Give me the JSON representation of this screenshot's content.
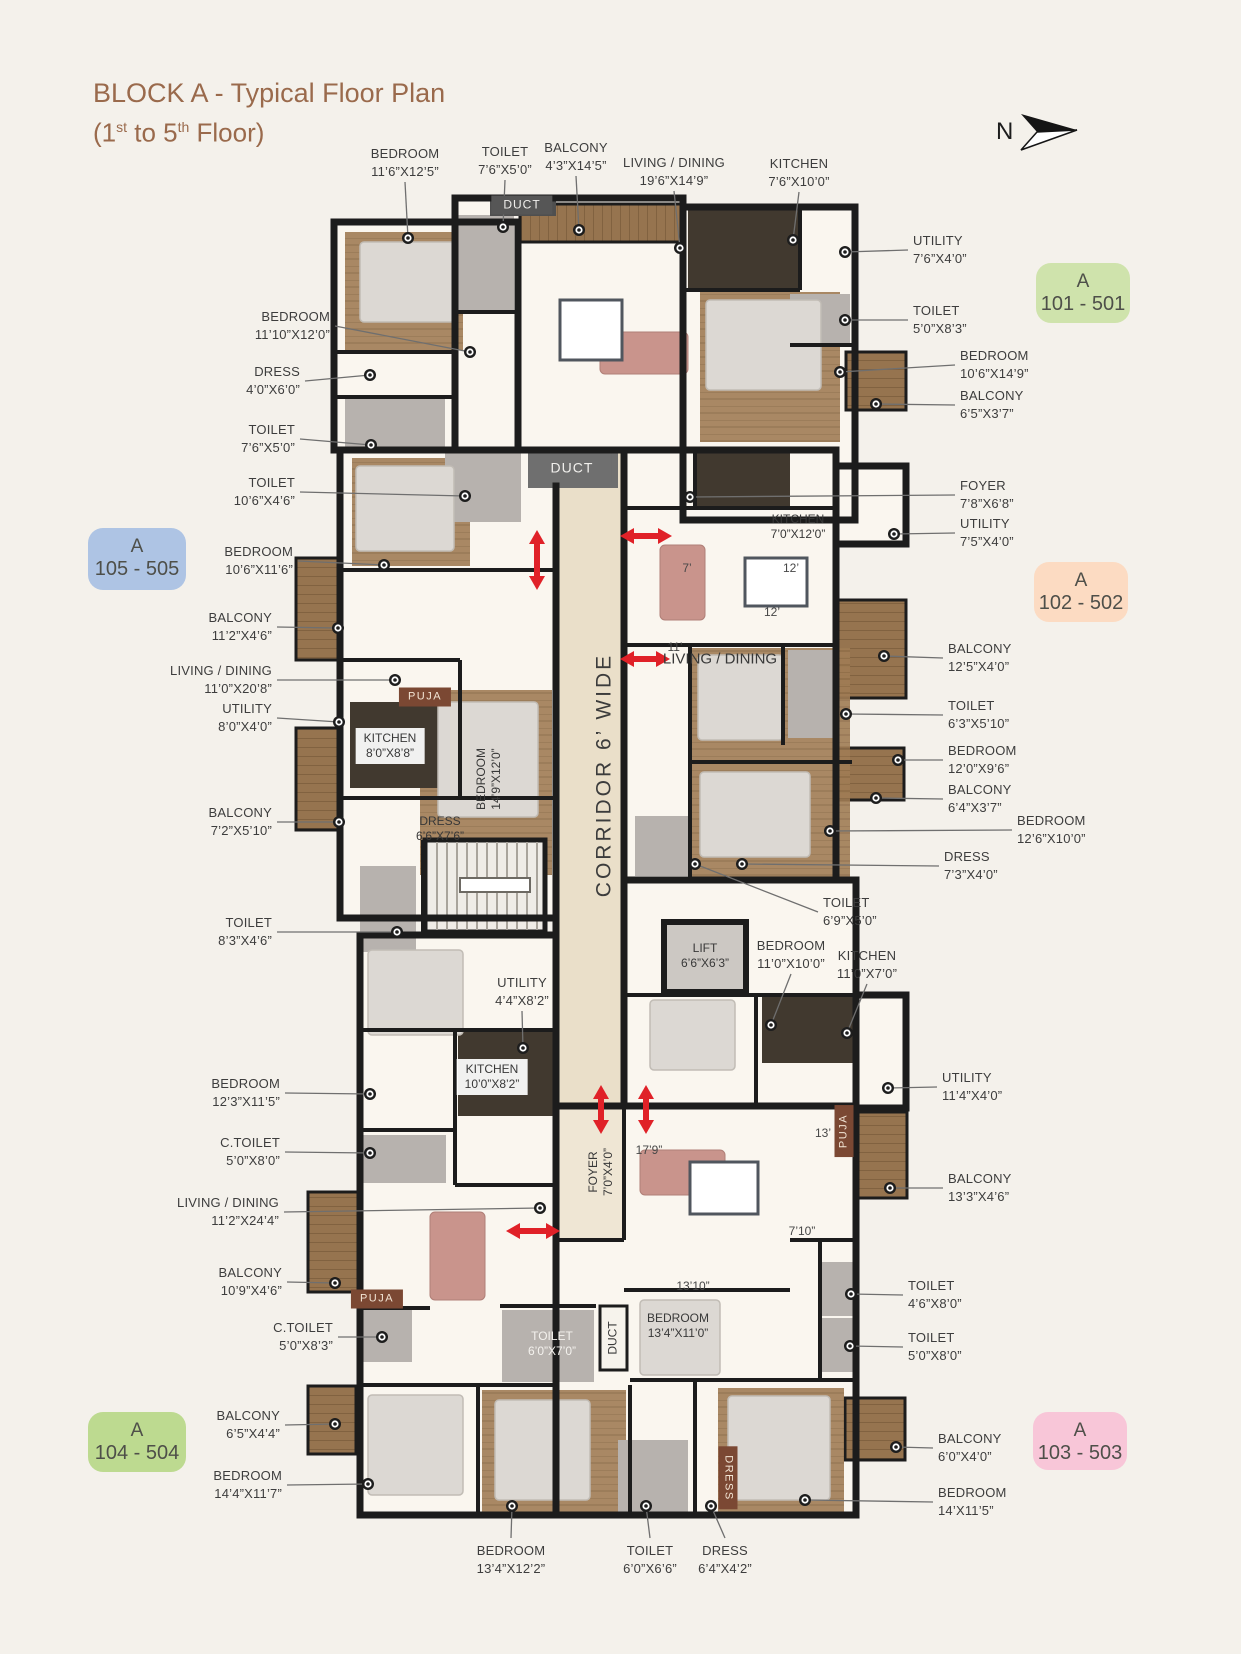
{
  "title": {
    "line1": "BLOCK A - Typical Floor Plan",
    "line2": {
      "p1": "(1",
      "s1": "st",
      "p2": " to 5",
      "s2": "th",
      "p3": " Floor)"
    }
  },
  "compass": {
    "label": "N"
  },
  "colors": {
    "title": "#9a6a4c",
    "label_text": "#3d3d3d",
    "wall": "#1c1c1c",
    "wood": "#96744f",
    "corridor_floor": "#eadfc9",
    "red_arrow": "#e02128",
    "badge_green": "#cfe3ac",
    "badge_blue": "#aec4e4",
    "bad ge_peach": "#fcdbc2",
    "badge_green2": "#bdda90",
    "badge_pink": "#f8c6d8"
  },
  "badges": [
    {
      "id": "101-501",
      "l1": "A",
      "l2": "101 - 501",
      "x": 1036,
      "y": 263,
      "w": 94,
      "h": 60,
      "bg": "#cfe3ac"
    },
    {
      "id": "105-505",
      "l1": "A",
      "l2": "105 - 505",
      "x": 88,
      "y": 528,
      "w": 98,
      "h": 62,
      "bg": "#aec4e4"
    },
    {
      "id": "102-502",
      "l1": "A",
      "l2": "102 - 502",
      "x": 1034,
      "y": 562,
      "w": 94,
      "h": 60,
      "bg": "#fcdbc2"
    },
    {
      "id": "104-504",
      "l1": "A",
      "l2": "104 - 504",
      "x": 88,
      "y": 1412,
      "w": 98,
      "h": 60,
      "bg": "#bdda90"
    },
    {
      "id": "103-503",
      "l1": "A",
      "l2": "103 - 503",
      "x": 1033,
      "y": 1412,
      "w": 94,
      "h": 58,
      "bg": "#f8c6d8"
    }
  ],
  "callouts": [
    {
      "n": "BEDROOM",
      "d": "11’6”X12’5”",
      "a": "center",
      "dir": "down",
      "x": 405,
      "ty": 145,
      "dx": 408,
      "dy": 238
    },
    {
      "n": "TOILET",
      "d": "7’6”X5’0”",
      "a": "center",
      "dir": "down",
      "x": 505,
      "ty": 143,
      "dx": 503,
      "dy": 227
    },
    {
      "n": "BALCONY",
      "d": "4’3”X14’5”",
      "a": "center",
      "dir": "down",
      "x": 576,
      "ty": 139,
      "dx": 579,
      "dy": 230
    },
    {
      "n": "LIVING / DINING",
      "d": "19’6”X14’9”",
      "a": "center",
      "dir": "down",
      "x": 674,
      "ty": 154,
      "dx": 680,
      "dy": 248
    },
    {
      "n": "KITCHEN",
      "d": "7’6”X10’0”",
      "a": "center",
      "dir": "down",
      "x": 799,
      "ty": 155,
      "dx": 793,
      "dy": 240
    },
    {
      "n": "UTILITY",
      "d": "7’6”X4’0”",
      "a": "left",
      "x": 913,
      "ty": 232,
      "dx": 845,
      "dy": 252
    },
    {
      "n": "TOILET",
      "d": "5’0”X8’3”",
      "a": "left",
      "x": 913,
      "ty": 302,
      "dx": 845,
      "dy": 320
    },
    {
      "n": "BEDROOM",
      "d": "10’6”X14’9”",
      "a": "left",
      "x": 960,
      "ty": 347,
      "dx": 840,
      "dy": 372
    },
    {
      "n": "BALCONY",
      "d": "6’5”X3’7”",
      "a": "left",
      "x": 960,
      "ty": 387,
      "dx": 876,
      "dy": 404
    },
    {
      "n": "FOYER",
      "d": "7’8”X6’8”",
      "a": "left",
      "x": 960,
      "ty": 477,
      "dx": 690,
      "dy": 497
    },
    {
      "n": "UTILITY",
      "d": "7’5”X4’0”",
      "a": "left",
      "x": 960,
      "ty": 515,
      "dx": 894,
      "dy": 534
    },
    {
      "n": "BALCONY",
      "d": "12’5”X4’0”",
      "a": "left",
      "x": 948,
      "ty": 640,
      "dx": 884,
      "dy": 656
    },
    {
      "n": "TOILET",
      "d": "6’3”X5’10”",
      "a": "left",
      "x": 948,
      "ty": 697,
      "dx": 846,
      "dy": 714
    },
    {
      "n": "BEDROOM",
      "d": "12’0”X9’6”",
      "a": "left",
      "x": 948,
      "ty": 742,
      "dx": 898,
      "dy": 760
    },
    {
      "n": "BALCONY",
      "d": "6’4”X3’7”",
      "a": "left",
      "x": 948,
      "ty": 781,
      "dx": 876,
      "dy": 798
    },
    {
      "n": "BEDROOM",
      "d": "12’6”X10’0”",
      "a": "left",
      "x": 1017,
      "ty": 812,
      "dx": 830,
      "dy": 831
    },
    {
      "n": "DRESS",
      "d": "7’3”X4’0”",
      "a": "left",
      "x": 944,
      "ty": 848,
      "dx": 742,
      "dy": 864
    },
    {
      "n": "TOILET",
      "d": "6’9”X5’0”",
      "a": "left",
      "x": 823,
      "ty": 894,
      "dx": 695,
      "dy": 864
    },
    {
      "n": "UTILITY",
      "d": "11’4”X4’0”",
      "a": "left",
      "x": 942,
      "ty": 1069,
      "dx": 888,
      "dy": 1088
    },
    {
      "n": "BALCONY",
      "d": "13’3”X4’6”",
      "a": "left",
      "x": 948,
      "ty": 1170,
      "dx": 890,
      "dy": 1188
    },
    {
      "n": "TOILET",
      "d": "4’6”X8’0”",
      "a": "left",
      "x": 908,
      "ty": 1277,
      "dx": 851,
      "dy": 1294
    },
    {
      "n": "TOILET",
      "d": "5’0”X8’0”",
      "a": "left",
      "x": 908,
      "ty": 1329,
      "dx": 850,
      "dy": 1346
    },
    {
      "n": "BALCONY",
      "d": "6’0”X4’0”",
      "a": "left",
      "x": 938,
      "ty": 1430,
      "dx": 896,
      "dy": 1447
    },
    {
      "n": "BEDROOM",
      "d": "14’X11’5”",
      "a": "left",
      "x": 938,
      "ty": 1484,
      "dx": 805,
      "dy": 1500
    },
    {
      "n": "BEDROOM",
      "d": "11’10”X12’0”",
      "a": "right",
      "x": 330,
      "ty": 308,
      "dx": 470,
      "dy": 352
    },
    {
      "n": "DRESS",
      "d": "4’0”X6’0”",
      "a": "right",
      "x": 300,
      "ty": 363,
      "dx": 370,
      "dy": 375
    },
    {
      "n": "TOILET",
      "d": "7’6”X5’0”",
      "a": "right",
      "x": 295,
      "ty": 421,
      "dx": 371,
      "dy": 445
    },
    {
      "n": "TOILET",
      "d": "10’6”X4’6”",
      "a": "right",
      "x": 295,
      "ty": 474,
      "dx": 465,
      "dy": 496
    },
    {
      "n": "BEDROOM",
      "d": "10’6”X11’6”",
      "a": "right",
      "x": 293,
      "ty": 543,
      "dx": 384,
      "dy": 565
    },
    {
      "n": "BALCONY",
      "d": "11’2”X4’6”",
      "a": "right",
      "x": 272,
      "ty": 609,
      "dx": 338,
      "dy": 628
    },
    {
      "n": "LIVING / DINING",
      "d": "11’0”X20’8”",
      "a": "right",
      "x": 272,
      "ty": 662,
      "dx": 395,
      "dy": 680
    },
    {
      "n": "UTILITY",
      "d": "8’0”X4’0”",
      "a": "right",
      "x": 272,
      "ty": 700,
      "dx": 339,
      "dy": 722
    },
    {
      "n": "BALCONY",
      "d": "7’2”X5’10”",
      "a": "right",
      "x": 272,
      "ty": 804,
      "dx": 339,
      "dy": 822
    },
    {
      "n": "TOILET",
      "d": "8’3”X4’6”",
      "a": "right",
      "x": 272,
      "ty": 914,
      "dx": 397,
      "dy": 932
    },
    {
      "n": "BEDROOM",
      "d": "12’3”X11’5”",
      "a": "right",
      "x": 280,
      "ty": 1075,
      "dx": 370,
      "dy": 1094
    },
    {
      "n": "C.TOILET",
      "d": "5’0”X8’0”",
      "a": "right",
      "x": 280,
      "ty": 1134,
      "dx": 370,
      "dy": 1153
    },
    {
      "n": "LIVING / DINING",
      "d": "11’2”X24’4”",
      "a": "right",
      "x": 279,
      "ty": 1194,
      "dx": 540,
      "dy": 1208
    },
    {
      "n": "BALCONY",
      "d": "10’9”X4’6”",
      "a": "right",
      "x": 282,
      "ty": 1264,
      "dx": 335,
      "dy": 1283
    },
    {
      "n": "C.TOILET",
      "d": "5’0”X8’3”",
      "a": "right",
      "x": 333,
      "ty": 1319,
      "dx": 382,
      "dy": 1337
    },
    {
      "n": "BALCONY",
      "d": "6’5”X4’4”",
      "a": "right",
      "x": 280,
      "ty": 1407,
      "dx": 335,
      "dy": 1424
    },
    {
      "n": "BEDROOM",
      "d": "14’4”X11’7”",
      "a": "right",
      "x": 282,
      "ty": 1467,
      "dx": 368,
      "dy": 1484
    },
    {
      "n": "BEDROOM",
      "d": "11’0”X10’0”",
      "a": "center",
      "dir": "down",
      "x": 791,
      "ty": 937,
      "dx": 771,
      "dy": 1025
    },
    {
      "n": "KITCHEN",
      "d": "11’0”X7’0”",
      "a": "center",
      "dir": "down",
      "x": 867,
      "ty": 947,
      "dx": 847,
      "dy": 1033
    },
    {
      "n": "UTILITY",
      "d": "4’4”X8’2”",
      "a": "center",
      "dir": "down",
      "x": 522,
      "ty": 974,
      "dx": 523,
      "dy": 1048
    },
    {
      "n": "BEDROOM",
      "d": "13’4”X12’2”",
      "a": "center",
      "dir": "up",
      "x": 511,
      "ty": 1542,
      "dx": 512,
      "dy": 1506
    },
    {
      "n": "TOILET",
      "d": "6’0”X6’6”",
      "a": "center",
      "dir": "up",
      "x": 650,
      "ty": 1542,
      "dx": 646,
      "dy": 1506
    },
    {
      "n": "DRESS",
      "d": "6’4”X4’2”",
      "a": "center",
      "dir": "up",
      "x": 725,
      "ty": 1542,
      "dx": 711,
      "dy": 1506
    }
  ],
  "plan_labels": [
    {
      "id": "duct-top",
      "lines": [
        "DUCT"
      ],
      "x": 522,
      "y": 205,
      "style": "duct"
    },
    {
      "id": "duct-mid",
      "lines": [
        "DUCT"
      ],
      "x": 572,
      "y": 468,
      "style": "duct big"
    },
    {
      "id": "kitchen-102",
      "lines": [
        "KITCHEN",
        "7’0”X12’0”"
      ],
      "x": 798,
      "y": 527,
      "style": ""
    },
    {
      "id": "puja-105",
      "lines": [
        "PUJA"
      ],
      "x": 425,
      "y": 697,
      "style": "puja"
    },
    {
      "id": "kitchen-105",
      "lines": [
        "KITCHEN",
        "8’0”X8’8”"
      ],
      "x": 390,
      "y": 746,
      "style": "whitebox"
    },
    {
      "id": "dress-105",
      "lines": [
        "DRESS",
        "6’6”X7’6”"
      ],
      "x": 440,
      "y": 829,
      "style": ""
    },
    {
      "id": "bedroom-105",
      "lines": [
        "BEDROOM",
        "14’9”X12’0”"
      ],
      "x": 489,
      "y": 779,
      "style": "rotm90"
    },
    {
      "id": "corridor",
      "lines": [
        "CORRIDOR 6’ WIDE"
      ],
      "x": 604,
      "y": 775,
      "style": "corridor rotm90"
    },
    {
      "id": "lift",
      "lines": [
        "LIFT",
        "6’6”X6’3”"
      ],
      "x": 705,
      "y": 956,
      "style": ""
    },
    {
      "id": "kitchen-104",
      "lines": [
        "KITCHEN",
        "10’0”X8’2”"
      ],
      "x": 492,
      "y": 1077,
      "style": "whitebox"
    },
    {
      "id": "foyer-104",
      "lines": [
        "FOYER",
        "7’0”X4’0”"
      ],
      "x": 601,
      "y": 1172,
      "style": "rotm90"
    },
    {
      "id": "puja-103",
      "lines": [
        "PUJA"
      ],
      "x": 844,
      "y": 1131,
      "style": "puja rotm90"
    },
    {
      "id": "toilet-103",
      "lines": [
        "TOILET",
        "6’0”X7’0”"
      ],
      "x": 552,
      "y": 1344,
      "style": "white"
    },
    {
      "id": "duct-bottom",
      "lines": [
        "DUCT"
      ],
      "x": 613,
      "y": 1338,
      "style": "rotm90"
    },
    {
      "id": "bedroom-103-mid",
      "lines": [
        "BEDROOM",
        "13’4”X11’0”"
      ],
      "x": 678,
      "y": 1326,
      "style": ""
    },
    {
      "id": "puja-104",
      "lines": [
        "PUJA"
      ],
      "x": 377,
      "y": 1299,
      "style": "puja"
    },
    {
      "id": "dress-103",
      "lines": [
        "DRESS"
      ],
      "x": 728,
      "y": 1478,
      "style": "puja rot90"
    },
    {
      "id": "living-dining-102",
      "lines": [
        "LIVING / DINING"
      ],
      "x": 720,
      "y": 659,
      "style": "ld"
    }
  ],
  "dims": [
    {
      "t": "7’",
      "x": 687,
      "y": 568
    },
    {
      "t": "12’",
      "x": 791,
      "y": 568
    },
    {
      "t": "12’",
      "x": 772,
      "y": 612
    },
    {
      "t": "11’",
      "x": 675,
      "y": 647
    },
    {
      "t": "17’9”",
      "x": 649,
      "y": 1150
    },
    {
      "t": "13’",
      "x": 823,
      "y": 1133
    },
    {
      "t": "7’10”",
      "x": 802,
      "y": 1231
    },
    {
      "t": "13’10”",
      "x": 693,
      "y": 1286
    }
  ]
}
